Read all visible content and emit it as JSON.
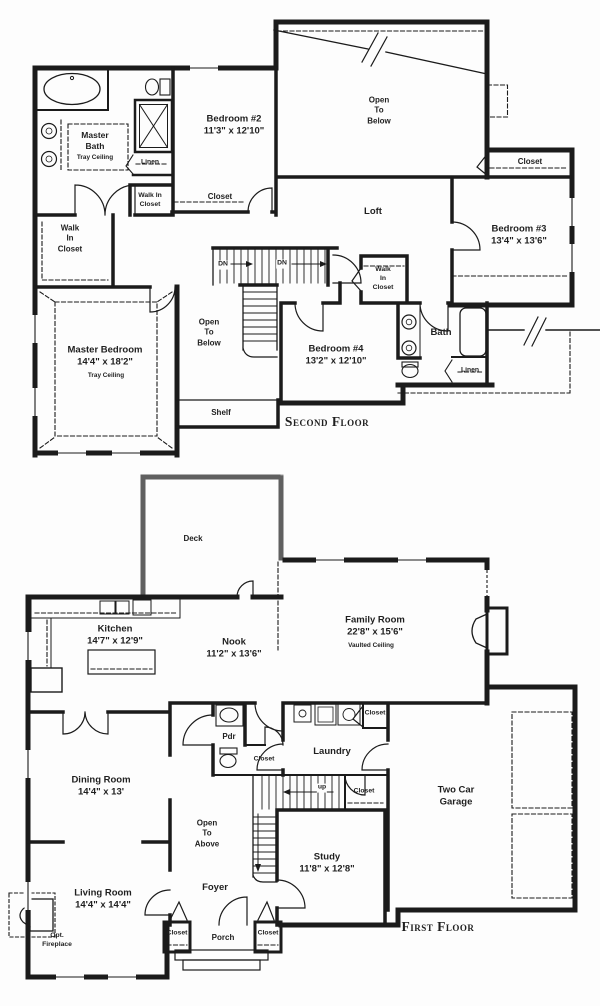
{
  "colors": {
    "line": "#1b1b1b",
    "background": "#fdfdfd",
    "deck_wall": "#a0a0a0"
  },
  "floors": {
    "second": {
      "title": "Second Floor",
      "rooms": {
        "master_bath": {
          "label": "Master\nBath",
          "note": "Tray Ceiling"
        },
        "bedroom2": {
          "label": "Bedroom #2\n11'3\" x 12'10\""
        },
        "bedroom2_closet": {
          "label": "Closet"
        },
        "open_below_top": {
          "label": "Open\nTo\nBelow"
        },
        "closet_top_right": {
          "label": "Closet"
        },
        "loft": {
          "label": "Loft"
        },
        "bedroom3": {
          "label": "Bedroom #3\n13'4\" x 13'6\""
        },
        "walk_in_closet_left": {
          "label": "Walk\nIn\nCloset"
        },
        "walk_in_closet_small": {
          "label": "Walk In\nCloset"
        },
        "linen_bath": {
          "label": "Linen"
        },
        "walk_in_closet_right": {
          "label": "Walk\nIn\nCloset"
        },
        "master_bedroom": {
          "label": "Master Bedroom\n14'4\" x 18'2\"",
          "note": "Tray Ceiling"
        },
        "open_below_mid": {
          "label": "Open\nTo\nBelow"
        },
        "bedroom4": {
          "label": "Bedroom #4\n13'2\" x 12'10\""
        },
        "bath": {
          "label": "Bath"
        },
        "linen2": {
          "label": "Linen"
        },
        "shelf": {
          "label": "Shelf"
        },
        "dn1": "DN",
        "dn2": "DN"
      }
    },
    "first": {
      "title": "First Floor",
      "rooms": {
        "deck": {
          "label": "Deck"
        },
        "kitchen": {
          "label": "Kitchen\n14'7\" x 12'9\""
        },
        "nook": {
          "label": "Nook\n11'2\" x 13'6\""
        },
        "family_room": {
          "label": "Family Room\n22'8\" x 15'6\"",
          "note": "Vaulted Ceiling"
        },
        "pdr": {
          "label": "Pdr"
        },
        "closet_stair": {
          "label": "Closet"
        },
        "laundry": {
          "label": "Laundry"
        },
        "closet_laundry_top": {
          "label": "Closet"
        },
        "closet_laundry_bottom": {
          "label": "Closet"
        },
        "garage": {
          "label": "Two Car\nGarage"
        },
        "study": {
          "label": "Study\n11'8\" x 12'8\""
        },
        "open_above": {
          "label": "Open\nTo\nAbove"
        },
        "dining": {
          "label": "Dining Room\n14'4\" x 13'"
        },
        "living": {
          "label": "Living Room\n14'4\" x 14'4\""
        },
        "opt_fireplace": {
          "label": "Opt.\nFireplace"
        },
        "foyer": {
          "label": "Foyer"
        },
        "porch": {
          "label": "Porch"
        },
        "closet_porch_left": {
          "label": "Closet"
        },
        "closet_porch_right": {
          "label": "Closet"
        },
        "up": "up"
      }
    }
  }
}
